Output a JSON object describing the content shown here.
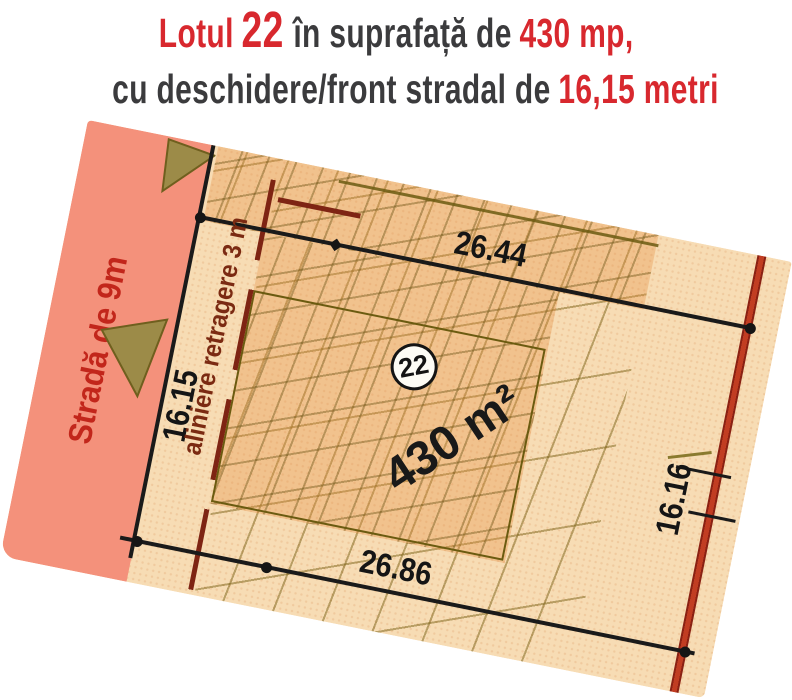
{
  "title": {
    "line1": {
      "lotul": "Lotul",
      "lot_number": "22",
      "middle": "în suprafață de",
      "area": "430 mp,"
    },
    "line2": {
      "prefix": "cu deschidere/front stradal de",
      "frontage": "16,15 metri"
    }
  },
  "plan": {
    "street_label": "Stradă de 9m",
    "alignment_label": "aliniere retragere 3 m",
    "front_dim": "16.15",
    "top_dim": "26.44",
    "bottom_dim": "26.86",
    "right_dim": "16.16",
    "area_label": "430 m²",
    "lot_number": "22"
  },
  "colors": {
    "title_red": "#d8282e",
    "title_dark": "#3b3b3d",
    "street_fill": "#f4917b",
    "plan_paper": "#f7dcb4",
    "dense_zone_tint": "#e68f42",
    "hatch_olive": "#7a6014",
    "setback_maroon": "#7e2413",
    "boundary_red": "#b5351e",
    "line_black": "#1a1a1a",
    "arrow_olive": "#9c8b48",
    "street_text_red": "#c2261b"
  }
}
